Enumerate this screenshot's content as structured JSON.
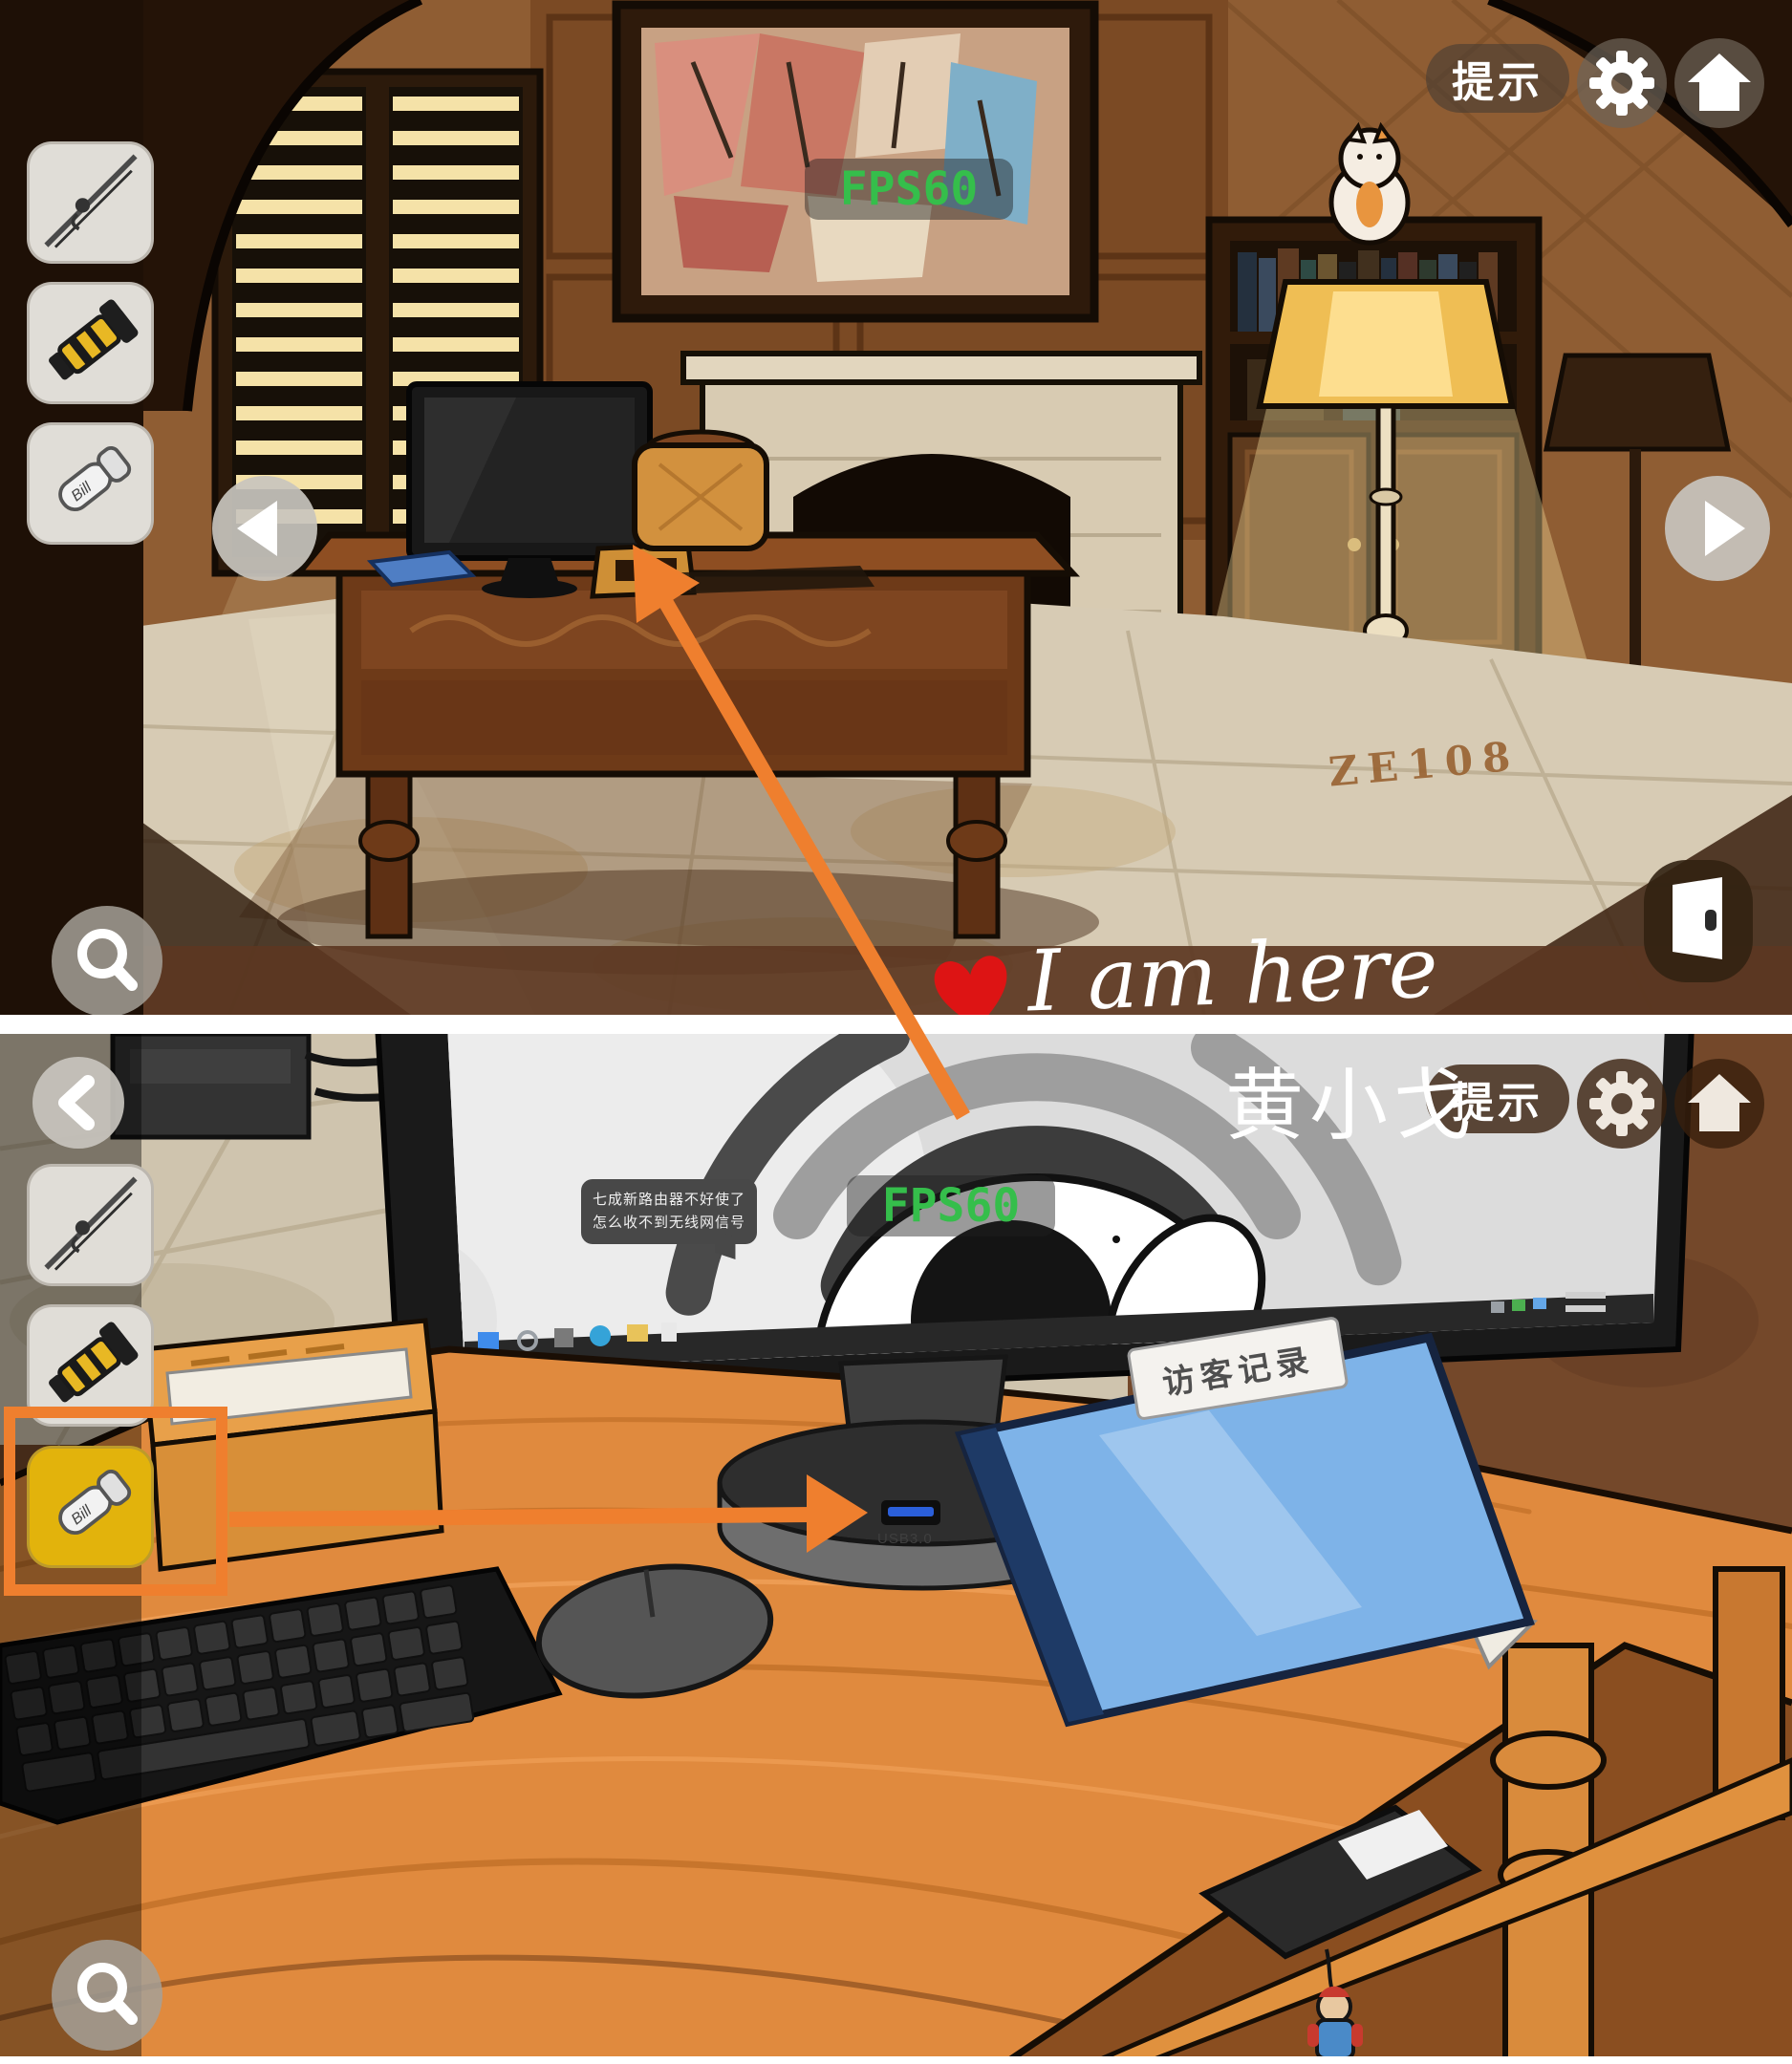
{
  "colors": {
    "annotation_orange": "#ef7f2e",
    "selected_slot_yellow": "#e2b30c",
    "fps_green": "#35be4b",
    "folder_blue": "#7eb3e8"
  },
  "hud": {
    "hint_label": "提示",
    "fps_label": "FPS60",
    "icons": [
      "gear-icon",
      "home-icon",
      "magnifier-icon",
      "door-exit-icon",
      "back-chevron-icon",
      "nav-arrow-left-icon",
      "nav-arrow-right-icon"
    ]
  },
  "inventory": {
    "usb_label": "Bill",
    "items": [
      {
        "label": "fishing-rod"
      },
      {
        "label": "flashlight"
      },
      {
        "label": "usb-drive"
      }
    ]
  },
  "top_scene": {
    "lamp_code": "ZE108"
  },
  "bottom_scene": {
    "monitor": {
      "speech_line1": "七成新路由器不好使了",
      "speech_line2": "怎么收不到无线网信号"
    },
    "usb_port_label": "USB3.0",
    "folder_label": "访客记录"
  },
  "annotations": {
    "here_text": "I am here",
    "watermark": "黄小戈"
  }
}
